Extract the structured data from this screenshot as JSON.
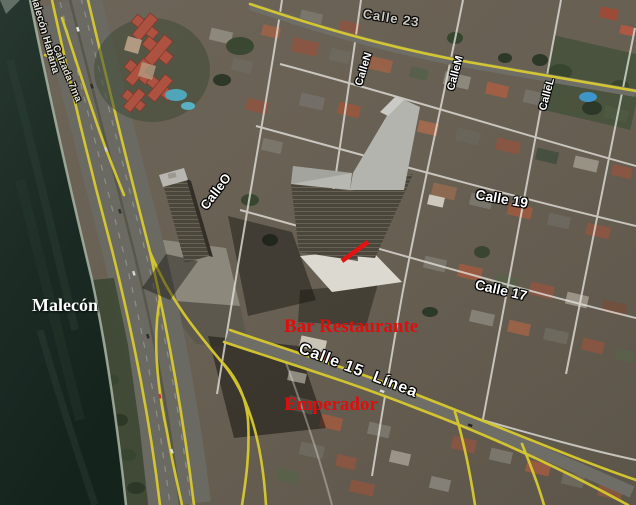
{
  "map": {
    "street_labels": {
      "malecon_habana": "Malecón Habana",
      "calzada_7ma": "Calzada 7ma",
      "calle_23": "Calle 23",
      "calle_n": "CalleN",
      "calle_m": "CalleM",
      "calle_l": "CalleL",
      "calle_o": "CalleO",
      "calle_19": "Calle 19",
      "calle_17": "Calle 17",
      "calle_15_linea": "Calle 15  Línea",
      "malecon": "Malecón"
    },
    "poi_labels": {
      "bar_restaurante_line1": "Bar Restaurante",
      "bar_restaurante_line2": "Emperador"
    },
    "colors": {
      "road_overlay_yellow": "#d8ca2f",
      "poi_label_red": "#e00d0d",
      "street_label_white": "#ffffff",
      "water_dark_teal": "#1b2b25"
    }
  }
}
